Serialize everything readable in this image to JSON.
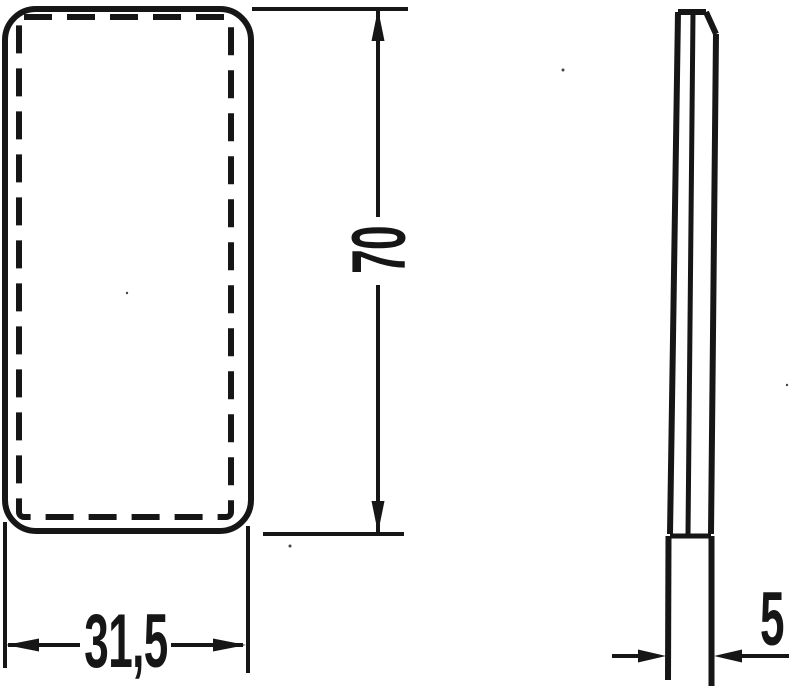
{
  "palette": {
    "ink": "#161616",
    "paper": "#ffffff"
  },
  "dimensions": {
    "height": {
      "label": "70"
    },
    "width": {
      "label": "31,5"
    },
    "thickness": {
      "label": "5"
    }
  }
}
